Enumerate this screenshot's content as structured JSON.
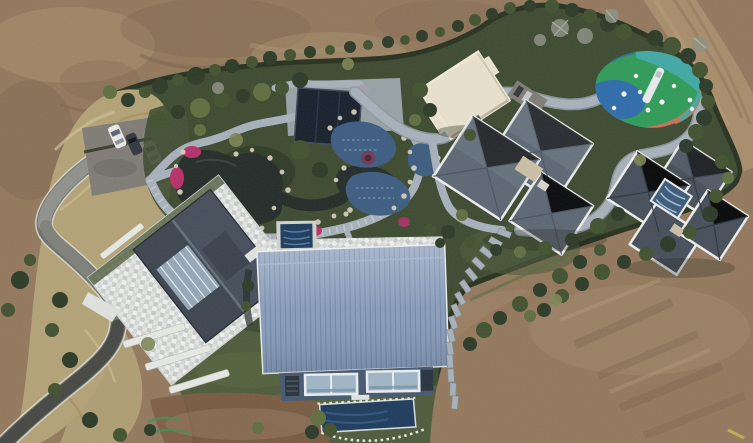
{
  "scene": {
    "type": "aerial-photo",
    "description": "Aerial drone view of a landscaped estate: winding driveway and parking with three cars, stone garden paths around dark koi ponds with pink azalea beds and white rocks, blue tiled pools under a dark canopy, cream flat-roofed pavilion, colorful children's playground, two grey hip-roofed houses, a large blue metal-roofed hall with window band and plunge pools, lawns, hedges and shrubs, all surrounded by bare brown earth and a dirt track",
    "regions": [
      {
        "id": "bare-earth",
        "label": "graded bare earth surrounding the property"
      },
      {
        "id": "dirt-track",
        "label": "dirt access track along top right"
      },
      {
        "id": "driveway",
        "label": "S-curved paved driveway from bottom left"
      },
      {
        "id": "parking",
        "label": "gravel parking pad with three parked cars"
      },
      {
        "id": "tall-grass",
        "label": "dry tall-grass bank along the west side"
      },
      {
        "id": "garden",
        "label": "ornamental garden with ponds, rocks and azaleas"
      },
      {
        "id": "pool-area",
        "label": "blue mosaic pools with dark canopy"
      },
      {
        "id": "pavilion",
        "label": "cream flat-roofed pavilion"
      },
      {
        "id": "playground",
        "label": "multicoloured playground with white slide"
      },
      {
        "id": "house-a",
        "label": "grey cross-plan house, centre right"
      },
      {
        "id": "house-b",
        "label": "grey cross-plan house with glass atrium, far right"
      },
      {
        "id": "left-house",
        "label": "gabled house with white tiled patio"
      },
      {
        "id": "blue-hall",
        "label": "large blue standing-seam roof hall"
      },
      {
        "id": "stone-steps",
        "label": "stone stepped path descending the slope"
      },
      {
        "id": "lawn",
        "label": "lawn below the buildings"
      }
    ],
    "counts": {
      "cars": 3,
      "main_buildings": 4
    }
  },
  "palette": {
    "dirt_base": "#93785c",
    "dirt_light": "#a9906f",
    "dirt_dark": "#77604a",
    "dirt_road": "#a88d6b",
    "dirt_red": "#7c5b42",
    "grass_tan": "#b3a276",
    "grass_tan_light": "#cfc094",
    "hedge_dark": "#27311e",
    "prop_green": "#3c4a30",
    "lawn_green": "#4d5b3a",
    "lawn_light": "#5c6c42",
    "shrub_dark": "#2b3a26",
    "shrub_mid": "#41522f",
    "shrub_light": "#5f6e3f",
    "shrub_olive": "#7d8554",
    "tree_gray": "#8d9183",
    "road_light": "#8f918c",
    "asphalt": "#454743",
    "white_line": "#dcdcd4",
    "parking_gray": "#7f7c75",
    "car_white": "#e9e9e7",
    "car_dark": "#33373c",
    "patio_a": "#e3e6e3",
    "patio_b": "#c6ccc9",
    "roof_dark": "#454e5a",
    "roof_gray": "#5c6773",
    "roof_light": "#8894a1",
    "trim_white": "#eceeed",
    "glass_blue": "#9fb2c2",
    "pond_dark": "#232b28",
    "water_blue": "#3c5c80",
    "water_deep": "#1e3b5c",
    "canopy_navy": "#161f2b",
    "rock_white": "#d7d0bd",
    "stone_path": "#a7b1bb",
    "flower_pink": "#b62f67",
    "pavilion_cream": "#e8e1cc",
    "blue_roof": "#8398b8",
    "blue_roof_rib": "#69809f",
    "wall_blue": "#46586e",
    "vent_dark": "#27323d",
    "play_green": "#2f9b58",
    "play_blue": "#2e6cab",
    "play_orange": "#ce7050",
    "play_teal": "#41a8a4",
    "play_navy": "#1f3f69",
    "paint_green": "#3f8f52",
    "mark_yellow": "#c8b84a"
  }
}
